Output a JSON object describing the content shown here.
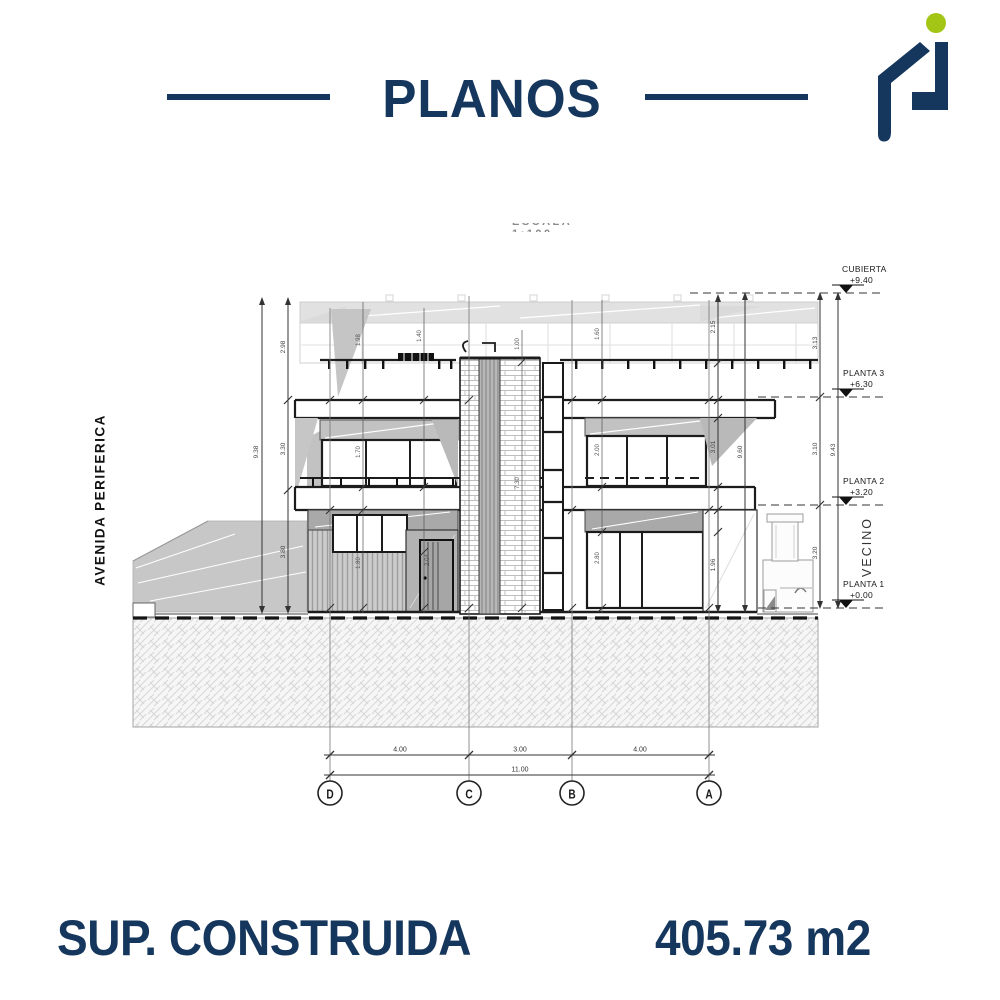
{
  "colors": {
    "navy": "#16375D",
    "green": "#A3C516",
    "line_dark": "#1a1a1a",
    "gray_fill": "#c6c6c6"
  },
  "header": {
    "title": "PLANOS"
  },
  "logo": {
    "name": "house-logo"
  },
  "drawing": {
    "scale_note": "ESCALA 1:100",
    "street_label": "AVENIDA PERIFERICA",
    "neighbor_label": "VECINO",
    "levels": [
      {
        "name": "CUBIERTA",
        "elevation": "+9.40"
      },
      {
        "name": "PLANTA 3",
        "elevation": "+6.30"
      },
      {
        "name": "PLANTA 2",
        "elevation": "+3.20"
      },
      {
        "name": "PLANTA 1",
        "elevation": "+0.00"
      }
    ],
    "grid_axes": [
      "D",
      "C",
      "B",
      "A"
    ],
    "bottom_dims": [
      "4.00",
      "3.00",
      "4.00"
    ],
    "total_dim": "11.00",
    "left_dims": {
      "total": "9.38",
      "segments": [
        "2.98",
        "3.30",
        "3.80"
      ]
    },
    "right_dims": {
      "col1_segments": [
        "2.15",
        "3.01",
        "1.96"
      ],
      "col2_total": "9.60",
      "col3_segments": [
        "3.13",
        "3.10",
        "3.20"
      ],
      "col4_total": "9.43"
    },
    "interior_dims": [
      "1.98",
      "1.40",
      "1.00",
      "1.60",
      "1.70",
      "2.00",
      "7.30",
      "1.80",
      "2.04",
      "2.80"
    ]
  },
  "footer": {
    "label": "SUP. CONSTRUIDA",
    "value": "405.73 m2"
  }
}
